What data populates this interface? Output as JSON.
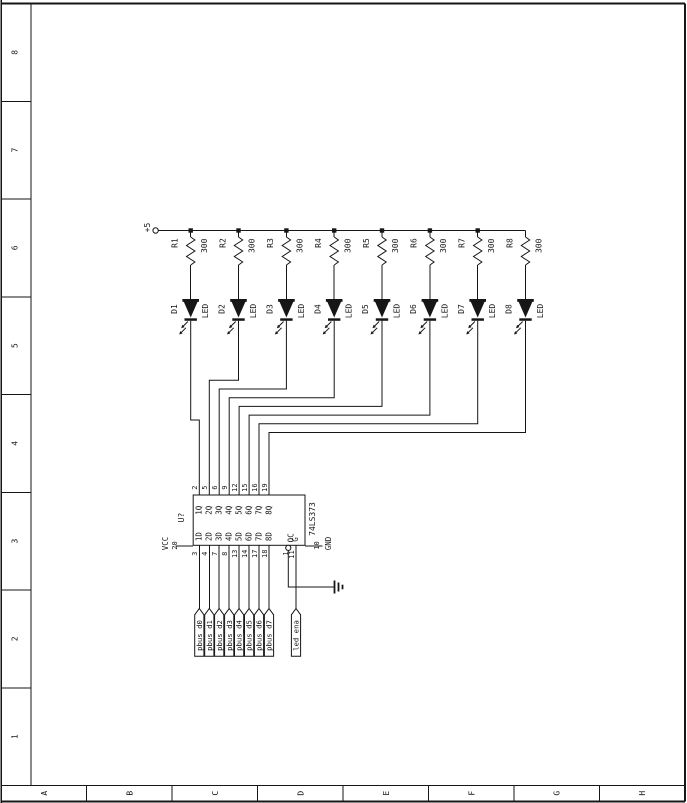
{
  "sheet": {
    "background": "#ffffff",
    "line_color": "#161616",
    "row_labels": [
      "8",
      "7",
      "6",
      "5",
      "4",
      "3",
      "2",
      "1"
    ],
    "col_labels": [
      "A",
      "B",
      "C",
      "D",
      "E",
      "F",
      "G",
      "H"
    ]
  },
  "power": {
    "label": "+5"
  },
  "resistors": [
    {
      "ref": "R1",
      "value": "300"
    },
    {
      "ref": "R2",
      "value": "300"
    },
    {
      "ref": "R3",
      "value": "300"
    },
    {
      "ref": "R4",
      "value": "300"
    },
    {
      "ref": "R5",
      "value": "300"
    },
    {
      "ref": "R6",
      "value": "300"
    },
    {
      "ref": "R7",
      "value": "300"
    },
    {
      "ref": "R8",
      "value": "300"
    }
  ],
  "leds": [
    {
      "ref": "D1",
      "label": "LED"
    },
    {
      "ref": "D2",
      "label": "LED"
    },
    {
      "ref": "D3",
      "label": "LED"
    },
    {
      "ref": "D4",
      "label": "LED"
    },
    {
      "ref": "D5",
      "label": "LED"
    },
    {
      "ref": "D6",
      "label": "LED"
    },
    {
      "ref": "D7",
      "label": "LED"
    },
    {
      "ref": "D8",
      "label": "LED"
    }
  ],
  "ic": {
    "refdes": "U?",
    "part": "74LS373",
    "outputs": [
      {
        "pin": "2",
        "label": "1Q"
      },
      {
        "pin": "5",
        "label": "2Q"
      },
      {
        "pin": "6",
        "label": "3Q"
      },
      {
        "pin": "9",
        "label": "4Q"
      },
      {
        "pin": "12",
        "label": "5Q"
      },
      {
        "pin": "15",
        "label": "6Q"
      },
      {
        "pin": "16",
        "label": "7Q"
      },
      {
        "pin": "19",
        "label": "8Q"
      }
    ],
    "inputs": [
      {
        "pin": "3",
        "label": "1D"
      },
      {
        "pin": "4",
        "label": "2D"
      },
      {
        "pin": "7",
        "label": "3D"
      },
      {
        "pin": "8",
        "label": "4D"
      },
      {
        "pin": "13",
        "label": "5D"
      },
      {
        "pin": "14",
        "label": "6D"
      },
      {
        "pin": "17",
        "label": "7D"
      },
      {
        "pin": "18",
        "label": "8D"
      }
    ],
    "oc": {
      "pin": "1",
      "label": "OC"
    },
    "gate": {
      "pin": "11",
      "label": "G"
    },
    "vcc": {
      "pin": "20",
      "label": "VCC"
    },
    "gnd": {
      "pin": "10",
      "label": "GND"
    }
  },
  "nets": {
    "data_flags": [
      "pbus_d0",
      "pbus_d1",
      "pbus_d2",
      "pbus_d3",
      "pbus_d4",
      "pbus_d5",
      "pbus_d6",
      "pbus_d7"
    ],
    "enable_flag": "led_ena"
  }
}
